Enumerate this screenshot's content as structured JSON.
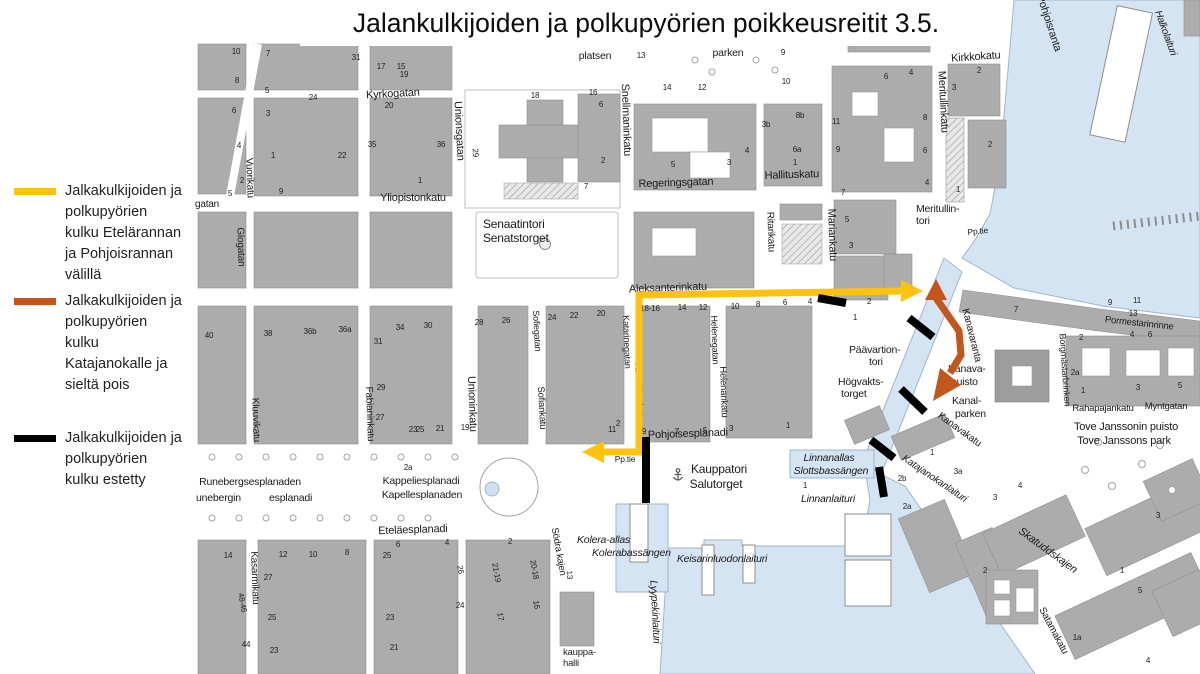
{
  "title": "Jalankulkijoiden ja polkupyörien poikkeusreitit 3.5.",
  "colors": {
    "route_yellow": "#FFC20E",
    "route_orange": "#C5561B",
    "route_blocked": "#000000",
    "water": "#D5E4F2",
    "building": "#ACACAC"
  },
  "legend": {
    "items": [
      {
        "color": "#FFC20E",
        "text": "Jalkakulkijoiden ja\npolkupyörien\nkulku Etelärannan\nja Pohjoisrannan\nvälillä"
      },
      {
        "color": "#C5561B",
        "text": "Jalkakulkijoiden ja\npolkupyörien\nkulku\nKatajanokalle ja\nsieltä pois"
      },
      {
        "color": "#000000",
        "text": "Jalkakulkijoiden ja\npolkupyörien\nkulku estetty"
      }
    ]
  },
  "map": {
    "labels": [
      {
        "t": "Kyrkogatan",
        "x": 393,
        "y": 97,
        "r": -3,
        "s": 11
      },
      {
        "t": "Unionsgatan",
        "x": 456,
        "y": 131,
        "r": 87,
        "s": 11
      },
      {
        "t": "Yliopistonkatu",
        "x": 413,
        "y": 201,
        "s": 11
      },
      {
        "t": "Snellmaninkatu",
        "x": 623,
        "y": 120,
        "r": 88,
        "s": 11
      },
      {
        "t": "Regeringsgatan",
        "x": 676,
        "y": 186,
        "r": -2,
        "s": 11
      },
      {
        "t": "Hallituskatu",
        "x": 792,
        "y": 178,
        "r": -2,
        "s": 11
      },
      {
        "t": "Ritarikatu",
        "x": 768,
        "y": 232,
        "r": 88,
        "s": 10
      },
      {
        "t": "Mariankatu",
        "x": 829,
        "y": 235,
        "r": 88,
        "s": 11
      },
      {
        "t": "Meritullinkatu",
        "x": 940,
        "y": 102,
        "r": 87,
        "s": 11
      },
      {
        "t": "Kirkkokatu",
        "x": 976,
        "y": 60,
        "r": -4,
        "s": 11
      },
      {
        "t": "Pohjoisranta",
        "x": 1046,
        "y": 24,
        "r": 72,
        "s": 11
      },
      {
        "t": "Halkolaituri",
        "x": 1163,
        "y": 34,
        "r": 70,
        "s": 10,
        "i": 1
      },
      {
        "t": "Aleksanterinkatu",
        "x": 668,
        "y": 291,
        "r": -2,
        "s": 11
      },
      {
        "t": "Vuorikatu",
        "x": 247,
        "y": 178,
        "r": 88,
        "s": 10
      },
      {
        "t": "gatan",
        "x": 207,
        "y": 207,
        "s": 10
      },
      {
        "t": "Glogatan",
        "x": 238,
        "y": 247,
        "r": 88,
        "s": 10
      },
      {
        "t": "Kluuvikatu",
        "x": 253,
        "y": 420,
        "r": 88,
        "s": 10
      },
      {
        "t": "Fabianinkatu",
        "x": 367,
        "y": 414,
        "r": 88,
        "s": 10
      },
      {
        "t": "Unioninkatu",
        "x": 469,
        "y": 404,
        "r": 88,
        "s": 11
      },
      {
        "t": "Sofiegatan",
        "x": 534,
        "y": 331,
        "r": 87,
        "s": 9
      },
      {
        "t": "Sofiankatu",
        "x": 539,
        "y": 408,
        "r": 87,
        "s": 9.5
      },
      {
        "t": "Katarinegatan",
        "x": 624,
        "y": 342,
        "r": 88,
        "s": 9
      },
      {
        "t": "Katariinankatu",
        "x": 636,
        "y": 392,
        "r": 88,
        "s": 9.5
      },
      {
        "t": "Helenegatan",
        "x": 712,
        "y": 340,
        "r": 88,
        "s": 9
      },
      {
        "t": "Helenankatu",
        "x": 721,
        "y": 392,
        "r": 88,
        "s": 9.5
      },
      {
        "t": "Pohjoisesplanadi",
        "x": 688,
        "y": 437,
        "r": -2,
        "s": 11
      },
      {
        "t": "Eteläesplanadi",
        "x": 413,
        "y": 533,
        "r": -2,
        "s": 11
      },
      {
        "t": "Kasarmikatu",
        "x": 252,
        "y": 578,
        "r": 88,
        "s": 10
      },
      {
        "t": "Södra kajen",
        "x": 556,
        "y": 552,
        "r": 80,
        "s": 9.5
      },
      {
        "t": "Kanavaranta",
        "x": 969,
        "y": 336,
        "r": 76,
        "s": 10
      },
      {
        "t": "Kanavakatu",
        "x": 958,
        "y": 432,
        "r": 36,
        "s": 10
      },
      {
        "t": "Katajanokanlaituri",
        "x": 933,
        "y": 481,
        "r": 34,
        "s": 10,
        "i": 1
      },
      {
        "t": "Skatuddskajen",
        "x": 1046,
        "y": 553,
        "r": 36,
        "s": 11,
        "i": 1
      },
      {
        "t": "Satamakatu",
        "x": 1051,
        "y": 632,
        "r": 62,
        "s": 10
      },
      {
        "t": "Pormestarinrinne",
        "x": 1139,
        "y": 326,
        "r": 6,
        "s": 9.5
      },
      {
        "t": "Borgmästarbrinken",
        "x": 1062,
        "y": 370,
        "r": 86,
        "s": 9
      },
      {
        "t": "Rahapajankatu",
        "x": 1103,
        "y": 411,
        "s": 9.5
      },
      {
        "t": "Myntgatan",
        "x": 1166,
        "y": 409,
        "s": 9.5
      },
      {
        "t": "Pp.tie",
        "x": 625,
        "y": 462,
        "s": 8.5
      },
      {
        "t": "Pp.tie",
        "x": 978,
        "y": 234,
        "r": -6,
        "s": 8.5
      },
      {
        "t": "Senaatintori",
        "x": 483,
        "y": 228,
        "a": "s",
        "s": 12
      },
      {
        "t": "Senatstorget",
        "x": 483,
        "y": 242,
        "a": "s",
        "s": 12
      },
      {
        "t": "platsen",
        "x": 595,
        "y": 59,
        "s": 10.5
      },
      {
        "t": "parken",
        "x": 728,
        "y": 56,
        "s": 10.5
      },
      {
        "t": "Meritullin-",
        "x": 916,
        "y": 212,
        "a": "s",
        "s": 10.5
      },
      {
        "t": "tori",
        "x": 916,
        "y": 224,
        "a": "s",
        "s": 10.5
      },
      {
        "t": "Päävartion-",
        "x": 849,
        "y": 353,
        "a": "s",
        "s": 10.5
      },
      {
        "t": "tori",
        "x": 869,
        "y": 365,
        "a": "s",
        "s": 10.5
      },
      {
        "t": "Högvakts-",
        "x": 838,
        "y": 385,
        "a": "s",
        "s": 10.5
      },
      {
        "t": "torget",
        "x": 841,
        "y": 397,
        "a": "s",
        "s": 10.5
      },
      {
        "t": "Kauppatori",
        "x": 719,
        "y": 473,
        "s": 12
      },
      {
        "t": "Salutorget",
        "x": 716,
        "y": 488,
        "s": 12
      },
      {
        "t": "Linnanallas",
        "x": 829,
        "y": 461,
        "s": 10.5,
        "i": 1
      },
      {
        "t": "Slottsbassängen",
        "x": 831,
        "y": 474,
        "s": 10.5,
        "i": 1
      },
      {
        "t": "Linnanlaituri",
        "x": 828,
        "y": 502,
        "s": 10.5,
        "i": 1
      },
      {
        "t": "Kolera-allas",
        "x": 577,
        "y": 543,
        "a": "s",
        "s": 10.5,
        "i": 1
      },
      {
        "t": "Kolerabassängen",
        "x": 592,
        "y": 556,
        "a": "s",
        "s": 10.5,
        "i": 1
      },
      {
        "t": "Keisarinluodonlaituri",
        "x": 722,
        "y": 562,
        "s": 10.5,
        "i": 1
      },
      {
        "t": "Lyypekinlaituri",
        "x": 652,
        "y": 612,
        "r": 87,
        "s": 10.5,
        "i": 1
      },
      {
        "t": "kauppa-",
        "x": 563,
        "y": 655,
        "a": "s",
        "s": 9.5
      },
      {
        "t": "halli",
        "x": 563,
        "y": 666,
        "a": "s",
        "s": 9.5
      },
      {
        "t": "Kanava-",
        "x": 948,
        "y": 372,
        "a": "s",
        "s": 10.5
      },
      {
        "t": "puisto",
        "x": 951,
        "y": 385,
        "a": "s",
        "s": 10.5
      },
      {
        "t": "Kanal-",
        "x": 952,
        "y": 404,
        "a": "s",
        "s": 10.5
      },
      {
        "t": "parken",
        "x": 955,
        "y": 417,
        "a": "s",
        "s": 10.5
      },
      {
        "t": "Tove Janssonin puisto",
        "x": 1126,
        "y": 430,
        "s": 11
      },
      {
        "t": "Tove Janssons park",
        "x": 1124,
        "y": 444,
        "s": 11
      },
      {
        "t": "Runebergsesplanaden",
        "x": 250,
        "y": 485,
        "s": 10.5
      },
      {
        "t": "unebergin",
        "x": 196,
        "y": 501,
        "a": "s",
        "s": 10.5
      },
      {
        "t": "esplanadi",
        "x": 269,
        "y": 501,
        "a": "s",
        "s": 10.5
      },
      {
        "t": "Kappeliesplanadi",
        "x": 421,
        "y": 484,
        "s": 10.5
      },
      {
        "t": "Kapellesplanaden",
        "x": 422,
        "y": 498,
        "s": 10.5
      }
    ],
    "house_numbers": [
      [
        "10",
        236,
        54
      ],
      [
        "8",
        237,
        83
      ],
      [
        "6",
        234,
        113
      ],
      [
        "4",
        239,
        148
      ],
      [
        "2",
        242,
        183
      ],
      [
        "5",
        230,
        196
      ],
      [
        "7",
        268,
        56
      ],
      [
        "5",
        267,
        93
      ],
      [
        "3",
        268,
        116
      ],
      [
        "1",
        273,
        158
      ],
      [
        "9",
        281,
        194
      ],
      [
        "26",
        333,
        44
      ],
      [
        "28",
        356,
        46
      ],
      [
        "24",
        313,
        100
      ],
      [
        "22",
        342,
        158
      ],
      [
        "31",
        356,
        60
      ],
      [
        "17",
        381,
        69
      ],
      [
        "15",
        401,
        69
      ],
      [
        "19",
        404,
        77
      ],
      [
        "20",
        389,
        108
      ],
      [
        "35",
        372,
        147
      ],
      [
        "36",
        441,
        147
      ],
      [
        "1",
        420,
        183
      ],
      [
        "13",
        641,
        58
      ],
      [
        "18",
        535,
        98
      ],
      [
        "16",
        593,
        95
      ],
      [
        "6",
        601,
        107
      ],
      [
        "2",
        603,
        163
      ],
      [
        "7",
        586,
        189
      ],
      [
        "29",
        473,
        153,
        85
      ],
      [
        "14",
        667,
        90
      ],
      [
        "12",
        702,
        90
      ],
      [
        "9",
        783,
        55
      ],
      [
        "10",
        786,
        84
      ],
      [
        "3b",
        766,
        127
      ],
      [
        "8b",
        800,
        118
      ],
      [
        "6a",
        797,
        152
      ],
      [
        "5",
        673,
        167
      ],
      [
        "3",
        729,
        165
      ],
      [
        "4",
        747,
        153
      ],
      [
        "1",
        795,
        165
      ],
      [
        "11",
        836,
        124
      ],
      [
        "9",
        838,
        152
      ],
      [
        "7",
        843,
        195
      ],
      [
        "5",
        847,
        222
      ],
      [
        "3",
        851,
        248
      ],
      [
        "7",
        852,
        45
      ],
      [
        "5",
        863,
        45
      ],
      [
        "3",
        903,
        45
      ],
      [
        "6",
        886,
        79
      ],
      [
        "4",
        911,
        75
      ],
      [
        "2",
        979,
        73
      ],
      [
        "3",
        954,
        90
      ],
      [
        "8",
        925,
        120
      ],
      [
        "6",
        925,
        153
      ],
      [
        "4",
        927,
        185
      ],
      [
        "1",
        958,
        192
      ],
      [
        "2",
        990,
        147
      ],
      [
        "40",
        209,
        338
      ],
      [
        "38",
        268,
        336
      ],
      [
        "36b",
        310,
        334
      ],
      [
        "36a",
        345,
        332
      ],
      [
        "34",
        400,
        330
      ],
      [
        "30",
        428,
        328
      ],
      [
        "31",
        378,
        344
      ],
      [
        "28",
        479,
        325
      ],
      [
        "26",
        506,
        323
      ],
      [
        "24",
        552,
        320
      ],
      [
        "22",
        574,
        318
      ],
      [
        "20",
        601,
        316
      ],
      [
        "27",
        380,
        420
      ],
      [
        "25",
        420,
        432
      ],
      [
        "29",
        381,
        390
      ],
      [
        "23",
        413,
        432
      ],
      [
        "21",
        440,
        431
      ],
      [
        "19",
        465,
        430
      ],
      [
        "18-16",
        650,
        311
      ],
      [
        "14",
        682,
        310
      ],
      [
        "12",
        703,
        310
      ],
      [
        "10",
        735,
        309
      ],
      [
        "8",
        758,
        307
      ],
      [
        "6",
        785,
        305
      ],
      [
        "4",
        810,
        304
      ],
      [
        "2",
        869,
        304
      ],
      [
        "1",
        855,
        320
      ],
      [
        "11",
        612,
        432
      ],
      [
        "2",
        618,
        426
      ],
      [
        "9",
        644,
        434
      ],
      [
        "7",
        677,
        434
      ],
      [
        "5",
        705,
        433
      ],
      [
        "3",
        731,
        431
      ],
      [
        "1",
        788,
        428
      ],
      [
        "2a",
        408,
        470
      ],
      [
        "14",
        228,
        558
      ],
      [
        "12",
        283,
        557
      ],
      [
        "10",
        313,
        557
      ],
      [
        "8",
        347,
        555
      ],
      [
        "6",
        398,
        547
      ],
      [
        "4",
        447,
        545
      ],
      [
        "2",
        510,
        544
      ],
      [
        "25",
        387,
        558
      ],
      [
        "23",
        390,
        620
      ],
      [
        "21",
        394,
        650
      ],
      [
        "27",
        268,
        580
      ],
      [
        "25",
        272,
        620
      ],
      [
        "23",
        274,
        653
      ],
      [
        "48-46",
        240,
        603,
        80
      ],
      [
        "44",
        246,
        647
      ],
      [
        "26",
        458,
        570,
        80
      ],
      [
        "24",
        460,
        608
      ],
      [
        "21-19",
        494,
        573,
        80
      ],
      [
        "20-18",
        532,
        570,
        80
      ],
      [
        "17",
        498,
        617,
        80
      ],
      [
        "16",
        534,
        605,
        80
      ],
      [
        "13",
        567,
        575,
        87
      ],
      [
        "1",
        805,
        488
      ],
      [
        "1",
        932,
        455
      ],
      [
        "2b",
        902,
        481
      ],
      [
        "2a",
        907,
        509
      ],
      [
        "3a",
        958,
        474
      ],
      [
        "7",
        1016,
        312
      ],
      [
        "9",
        1110,
        305
      ],
      [
        "11",
        1137,
        303
      ],
      [
        "13",
        1133,
        316
      ],
      [
        "2",
        1081,
        340
      ],
      [
        "4",
        1132,
        337
      ],
      [
        "6",
        1150,
        337
      ],
      [
        "1",
        1083,
        393
      ],
      [
        "3",
        1138,
        390
      ],
      [
        "5",
        1180,
        388
      ],
      [
        "2a",
        1075,
        375
      ],
      [
        "4",
        1020,
        488
      ],
      [
        "3",
        995,
        500
      ],
      [
        "3",
        1158,
        518
      ],
      [
        "1",
        1122,
        573
      ],
      [
        "5",
        1140,
        593
      ],
      [
        "1a",
        1077,
        640
      ],
      [
        "2",
        985,
        573
      ],
      [
        "4",
        1148,
        663
      ]
    ]
  }
}
